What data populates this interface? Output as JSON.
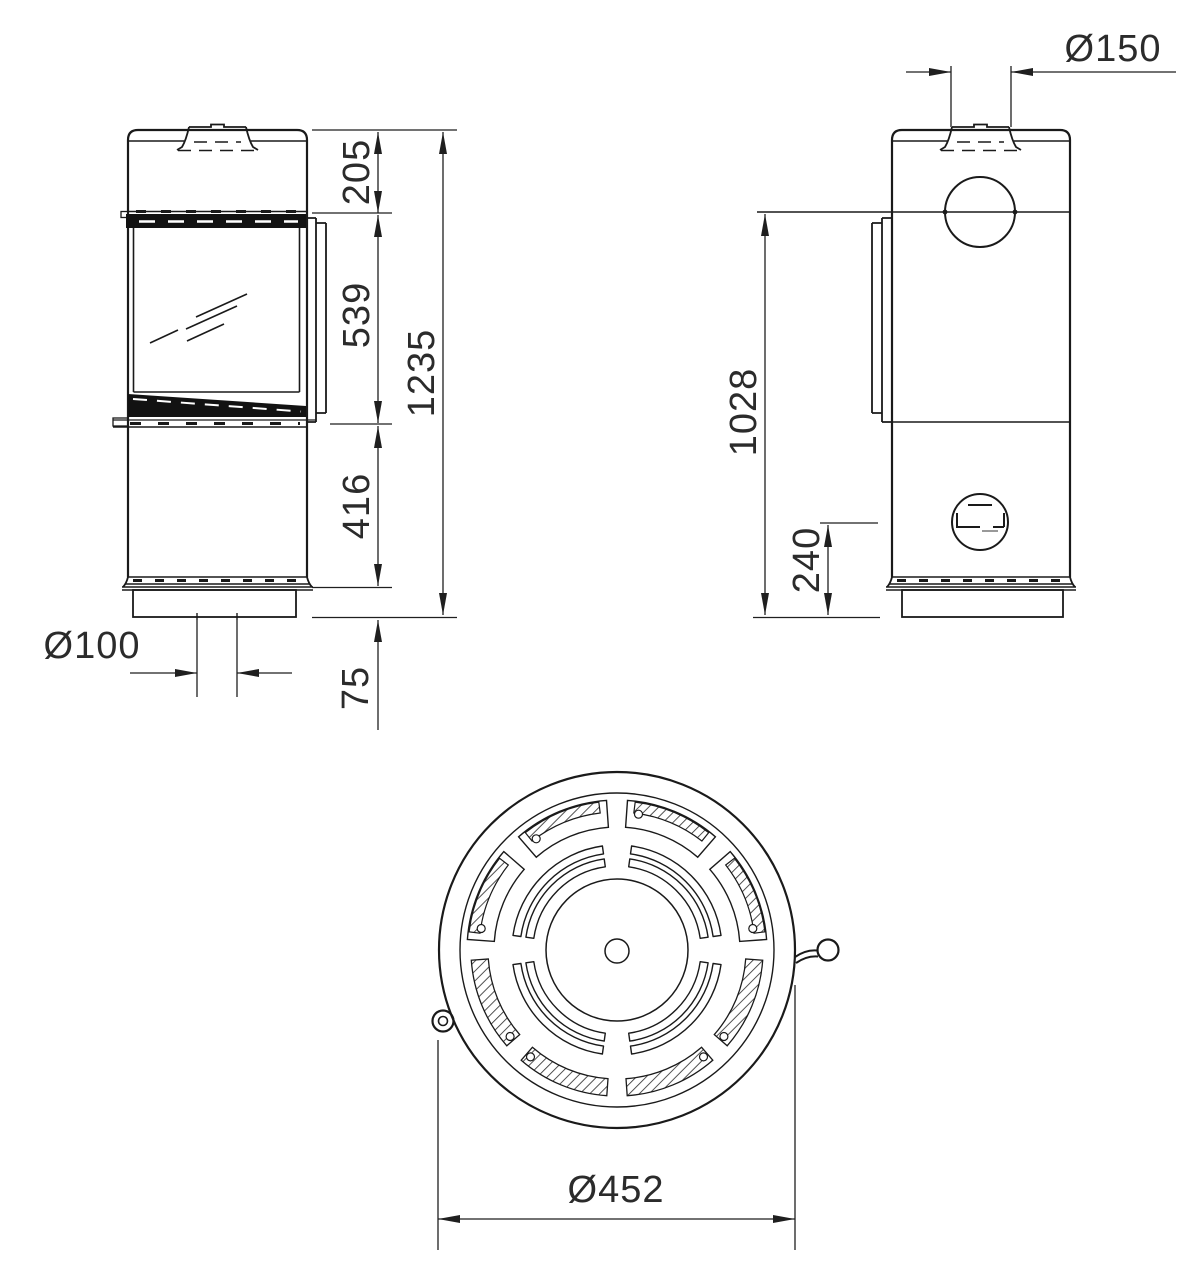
{
  "drawing": {
    "title": "stove-dimensional-drawing",
    "views": {
      "front": "front-view",
      "side": "side-view",
      "top": "top-view"
    },
    "dimensions": {
      "flue_diameter": "Ø150",
      "top_section_height": "205",
      "glass_door_height": "539",
      "total_height": "1235",
      "lower_section_height": "416",
      "plinth_height": "75",
      "floor_air_inlet_diameter": "Ø100",
      "rear_flue_outlet_center_height": "1028",
      "rear_air_inlet_center_height": "240",
      "body_diameter": "Ø452"
    }
  }
}
